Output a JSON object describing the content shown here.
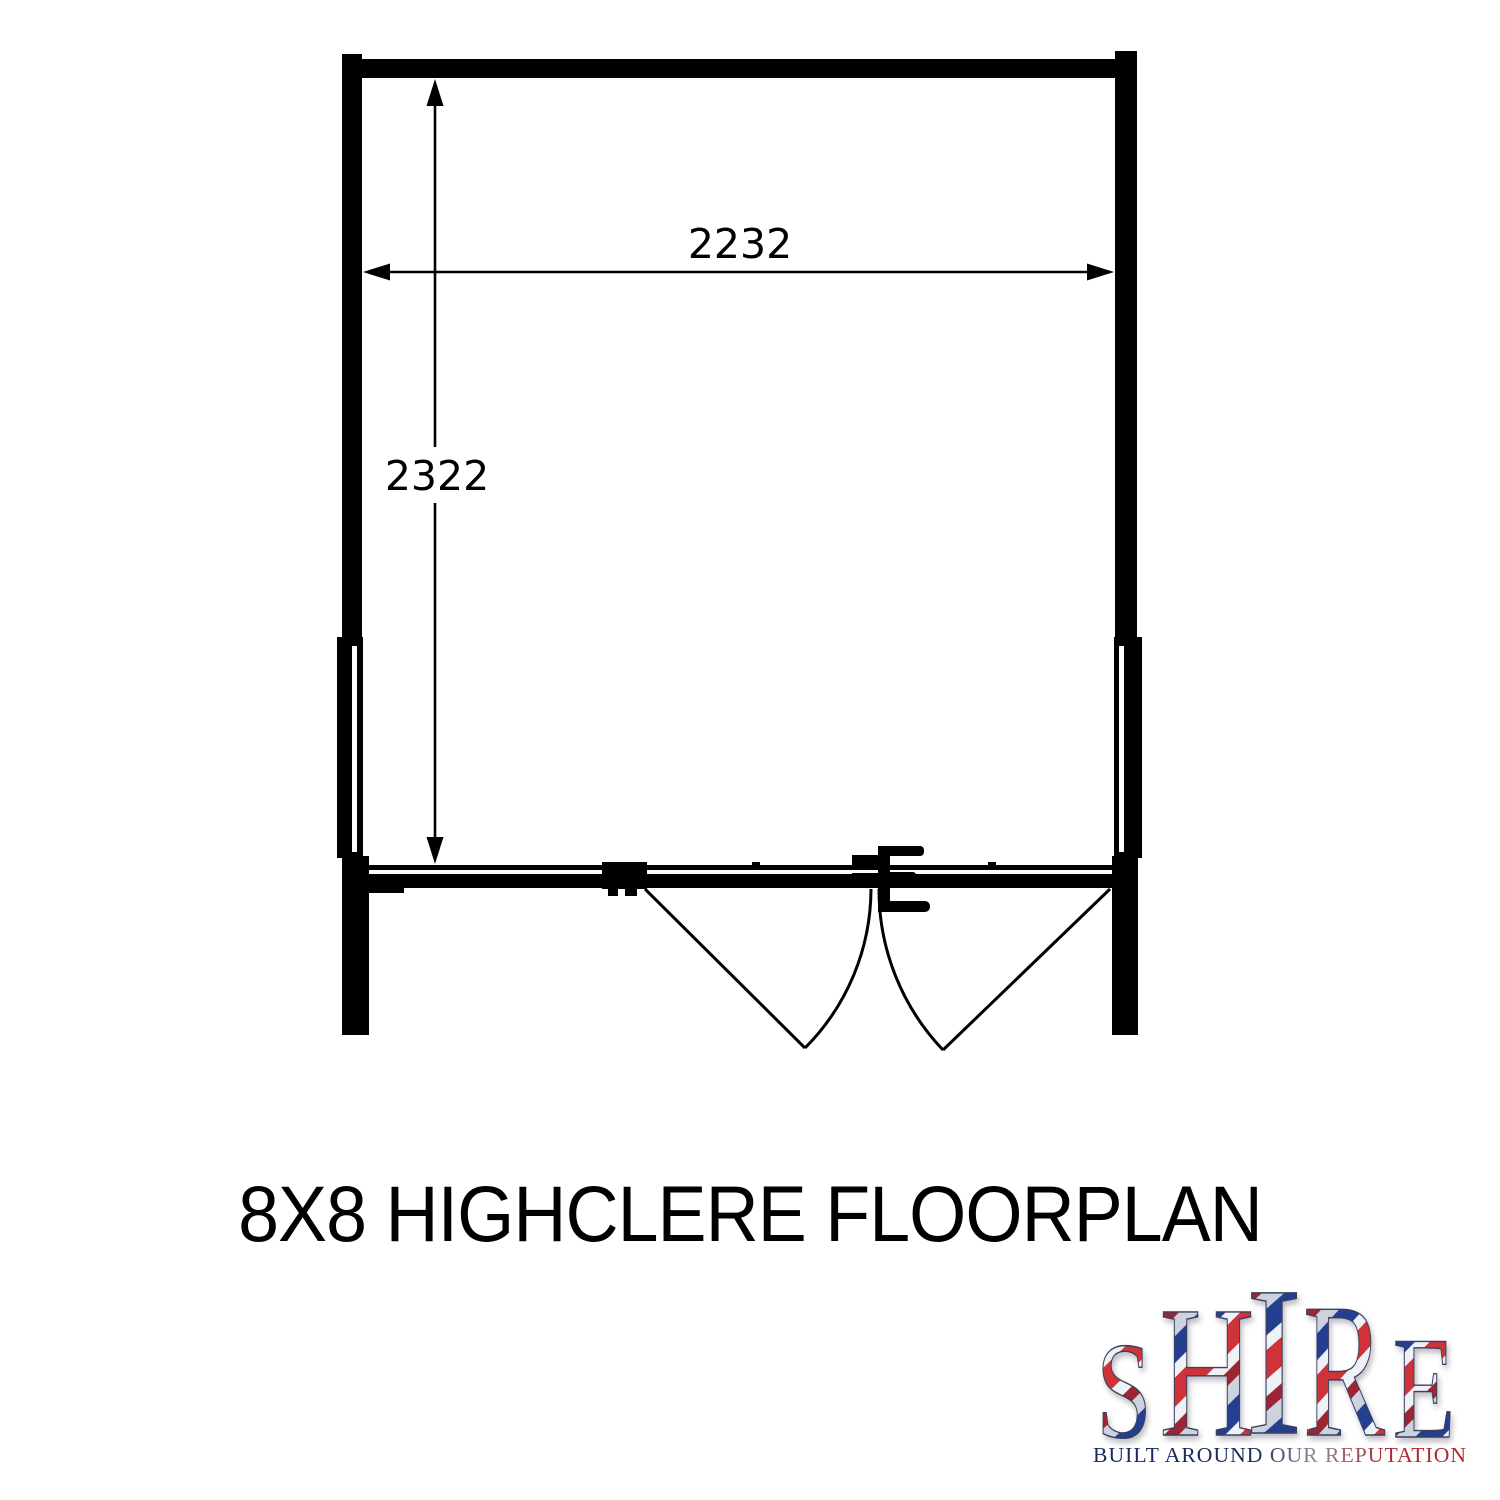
{
  "page": {
    "background": "#ffffff"
  },
  "floorplan": {
    "ink_color": "#000000",
    "width_label": "2232",
    "height_label": "2322"
  },
  "title": {
    "text": "8X8 HIGHCLERE FLOORPLAN"
  },
  "logo": {
    "name": "SHIRE",
    "letters": [
      "S",
      "H",
      "I",
      "R",
      "E"
    ],
    "tagline": "BUILT AROUND OUR REPUTATION",
    "colors": {
      "red": "#cf3339",
      "dark_red": "#9c2433",
      "blue": "#243f8f",
      "navy": "#1c2b5e",
      "silver": "#ccd3de",
      "white": "#eef1f6",
      "tag_mid": "#8c8f98",
      "tag_red": "#b02832",
      "outline": "#39405c"
    }
  }
}
